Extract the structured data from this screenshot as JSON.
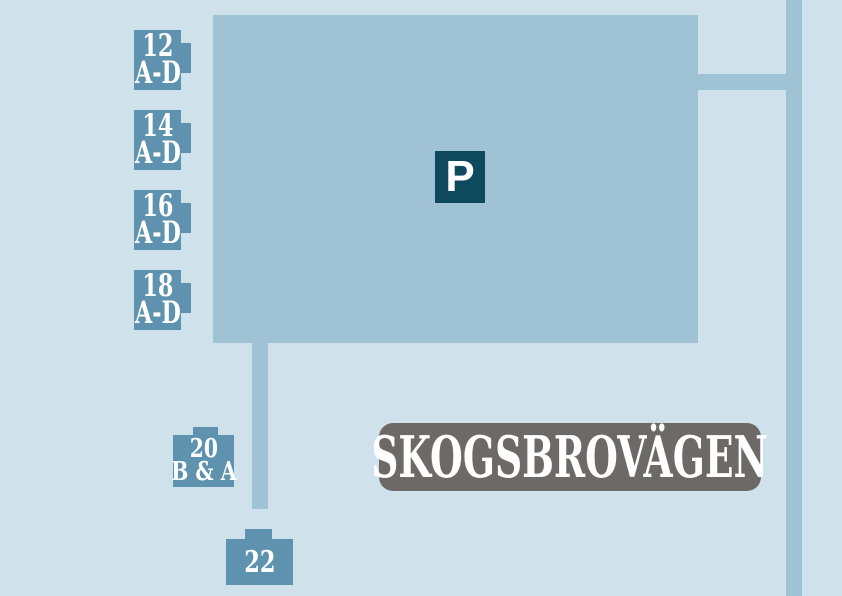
{
  "street_badge": {
    "label": "SKOGSBROVÄGEN"
  },
  "parking_sign": {
    "label": "P"
  },
  "buildings": [
    {
      "name": "12 A-D",
      "line1": "12",
      "line2": "A-D"
    },
    {
      "name": "14 A-D",
      "line1": "14",
      "line2": "A-D"
    },
    {
      "name": "16 A-D",
      "line1": "16",
      "line2": "A-D"
    },
    {
      "name": "18 A-D",
      "line1": "18",
      "line2": "A-D"
    },
    {
      "name": "20 B & A",
      "line1": "20",
      "line2": "B & A"
    },
    {
      "name": "22",
      "line1": "22",
      "line2": ""
    }
  ],
  "colors": {
    "background": "#cfe2ec",
    "road": "#9fc2d4",
    "building_marker": "#5e92ae",
    "parking_sign_bg": "#0e495e",
    "street_badge_bg": "#6d6967",
    "label_text": "#ffffff"
  }
}
